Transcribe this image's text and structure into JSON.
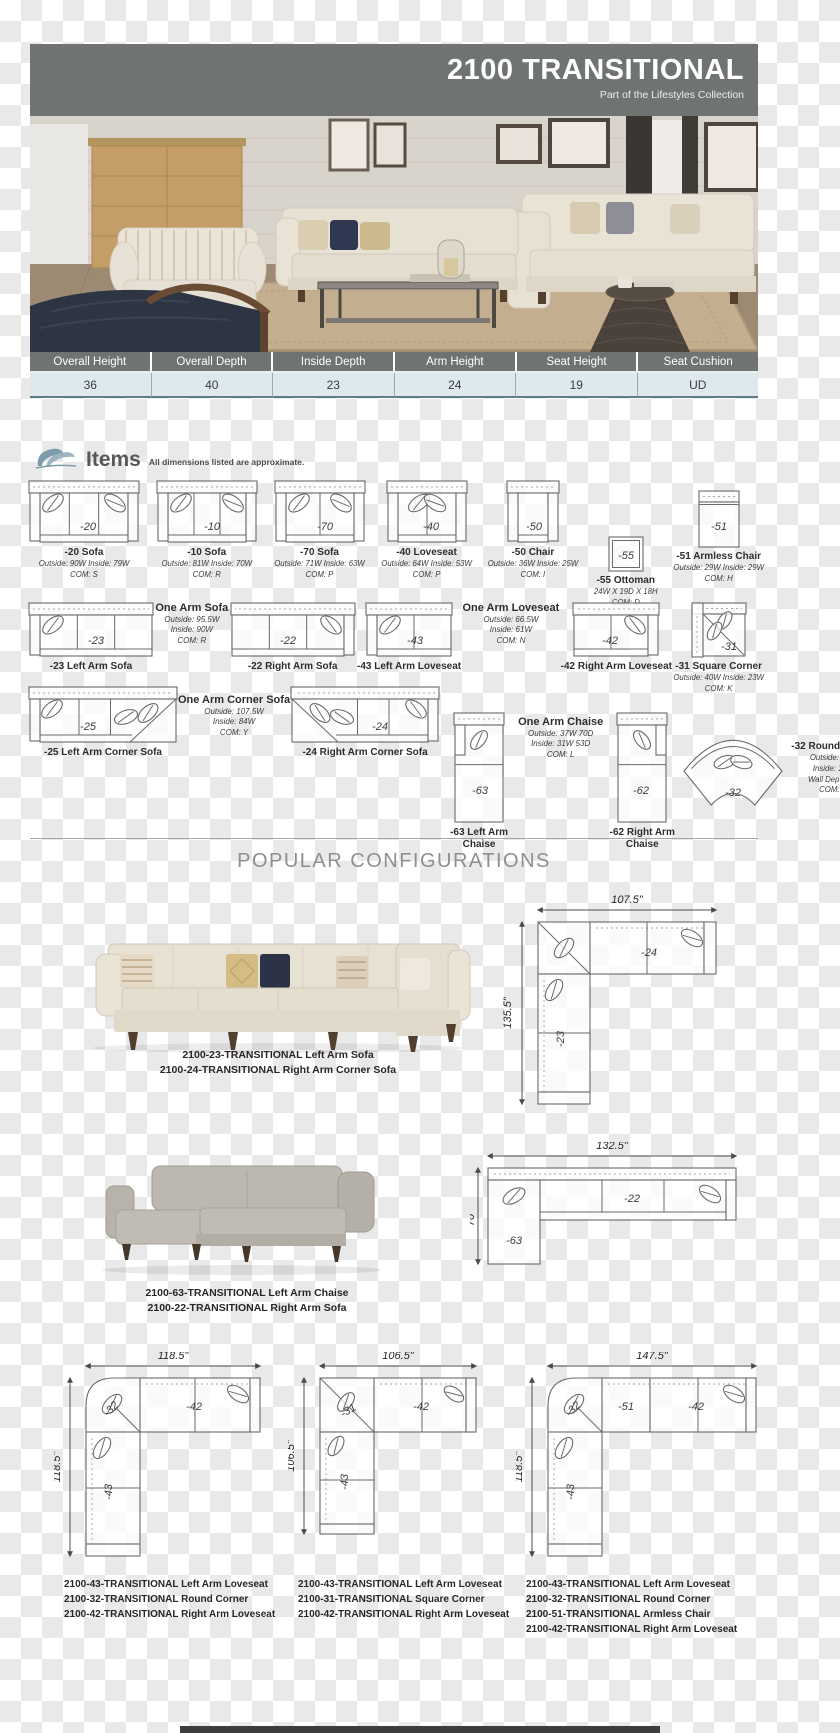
{
  "header": {
    "title": "2100 TRANSITIONAL",
    "subtitle": "Part of the Lifestyles Collection"
  },
  "spec_table": {
    "columns": [
      {
        "label": "Overall Height",
        "value": "36"
      },
      {
        "label": "Overall Depth",
        "value": "40"
      },
      {
        "label": "Inside Depth",
        "value": "23"
      },
      {
        "label": "Arm Height",
        "value": "24"
      },
      {
        "label": "Seat Height",
        "value": "19"
      },
      {
        "label": "Seat Cushion",
        "value": "UD"
      }
    ]
  },
  "items_section": {
    "title": "Items",
    "note": "All dimensions listed are approximate.",
    "logo_icon": "leaf-logo",
    "rows": [
      [
        {
          "code": "-20",
          "name": "-20 Sofa",
          "specs": [
            "Outside: 90W  Inside: 79W",
            "COM: S"
          ],
          "icon": "sofa-top-view"
        },
        {
          "code": "-10",
          "name": "-10 Sofa",
          "specs": [
            "Outside: 81W  Inside: 70W",
            "COM: R"
          ],
          "icon": "sofa-top-view"
        },
        {
          "code": "-70",
          "name": "-70 Sofa",
          "specs": [
            "Outside: 71W  Inside: 63W",
            "COM: P"
          ],
          "icon": "sofa-top-view"
        },
        {
          "code": "-40",
          "name": "-40 Loveseat",
          "specs": [
            "Outside: 64W  Inside: 53W",
            "COM: P"
          ],
          "icon": "loveseat-top-view"
        },
        {
          "code": "-50",
          "name": "-50 Chair",
          "specs": [
            "Outside: 36W  Inside: 25W",
            "COM: I"
          ],
          "icon": "chair-top-view"
        },
        {
          "code": "-55",
          "name": "-55 Ottoman",
          "specs": [
            "24W X 19D X 18H",
            "COM: D"
          ],
          "icon": "ottoman-top-view"
        },
        {
          "code": "-51",
          "name": "-51 Armless Chair",
          "specs": [
            "Outside: 29W  Inside: 29W",
            "COM: H"
          ],
          "icon": "armless-chair-top-view"
        }
      ],
      [
        {
          "code": "-23",
          "name": "-23 Left Arm Sofa",
          "specs": [],
          "icon": "one-arm-left-sofa-top-view"
        },
        {
          "spec_block": {
            "title": "One Arm Sofa",
            "lines": [
              "Outside: 95.5W",
              "Inside: 90W",
              "COM: R"
            ]
          }
        },
        {
          "code": "-22",
          "name": "-22 Right Arm Sofa",
          "specs": [],
          "icon": "one-arm-right-sofa-top-view"
        },
        {
          "code": "-43",
          "name": "-43 Left Arm Loveseat",
          "specs": [],
          "icon": "one-arm-left-loveseat-top-view"
        },
        {
          "spec_block": {
            "title": "One Arm Loveseat",
            "lines": [
              "Outside: 66.5W",
              "Inside: 61W",
              "COM: N"
            ]
          }
        },
        {
          "code": "-42",
          "name": "-42 Right Arm Loveseat",
          "specs": [],
          "icon": "one-arm-right-loveseat-top-view"
        },
        {
          "code": "-31",
          "name": "-31 Square Corner",
          "specs": [
            "Outside: 40W  Inside: 23W",
            "COM: K"
          ],
          "icon": "square-corner-top-view"
        }
      ],
      [
        {
          "code": "-25",
          "name": "-25 Left Arm Corner Sofa",
          "specs": [],
          "icon": "corner-sofa-left-top-view"
        },
        {
          "spec_block": {
            "title": "One Arm Corner Sofa",
            "lines": [
              "Outside: 107.5W",
              "Inside: 84W",
              "COM: Y"
            ]
          }
        },
        {
          "code": "-24",
          "name": "-24 Right Arm Corner Sofa",
          "specs": [],
          "icon": "corner-sofa-right-top-view"
        },
        {
          "code": "-63",
          "name": "-63 Left Arm Chaise",
          "specs": [],
          "icon": "chaise-left-top-view"
        },
        {
          "spec_block": {
            "title": "One Arm Chaise",
            "lines": [
              "Outside: 37W 70D",
              "Inside: 31W 53D",
              "COM: L"
            ]
          }
        },
        {
          "code": "-62",
          "name": "-62 Right Arm Chaise",
          "specs": [],
          "icon": "chaise-right-top-view"
        },
        {
          "code": "-32",
          "name": "-32 Round Corner",
          "specs": [
            "Outside: 74W",
            "Inside: 16W",
            "Wall Depth: 52",
            "COM: O"
          ],
          "icon": "round-corner-top-view",
          "specs_side": true
        }
      ]
    ]
  },
  "configurations": {
    "title": "POPULAR CONFIGURATIONS",
    "config1": {
      "caption": [
        "2100-23-TRANSITIONAL Left Arm Sofa",
        "2100-24-TRANSITIONAL Right Arm Corner Sofa"
      ],
      "diagram": {
        "top_dim": "107.5\"",
        "side_dim": "135.5\"",
        "label_h": "-24",
        "label_v": "-23"
      }
    },
    "config2": {
      "caption": [
        "2100-63-TRANSITIONAL Left Arm Chaise",
        "2100-22-TRANSITIONAL Right Arm Sofa"
      ],
      "diagram": {
        "top_dim": "132.5\"",
        "side_dim": "70\"",
        "label_chaise": "-63",
        "label_sofa": "-22"
      }
    },
    "config3": [
      {
        "caption": [
          "2100-43-TRANSITIONAL Left Arm Loveseat",
          "2100-32-TRANSITIONAL Round Corner",
          "2100-42-TRANSITIONAL Right Arm Loveseat"
        ],
        "diagram": {
          "top_dim": "118.5\"",
          "side_dim": "118.5\"",
          "label_corner": "-32",
          "label_h": "-42",
          "label_v": "-43"
        }
      },
      {
        "caption": [
          "2100-43-TRANSITIONAL Left Arm Loveseat",
          "2100-31-TRANSITIONAL Square Corner",
          "2100-42-TRANSITIONAL Right Arm Loveseat"
        ],
        "diagram": {
          "top_dim": "106.5\"",
          "side_dim": "106.5\"",
          "label_corner": "-31",
          "label_h": "-42",
          "label_v": "-43"
        }
      },
      {
        "caption": [
          "2100-43-TRANSITIONAL Left Arm Loveseat",
          "2100-32-TRANSITIONAL Round Corner",
          "2100-51-TRANSITIONAL Armless Chair",
          "2100-42-TRANSITIONAL Right Arm Loveseat"
        ],
        "diagram": {
          "top_dim": "147.5\"",
          "side_dim": "118.5\"",
          "label_corner": "-32",
          "label_mid": "-51",
          "label_h": "-42",
          "label_v": "-43"
        }
      }
    ]
  },
  "colors": {
    "header_gray": "#6f7372",
    "table_row_blue": "#dde9ec",
    "leaf_accent": "#84a2b0"
  }
}
